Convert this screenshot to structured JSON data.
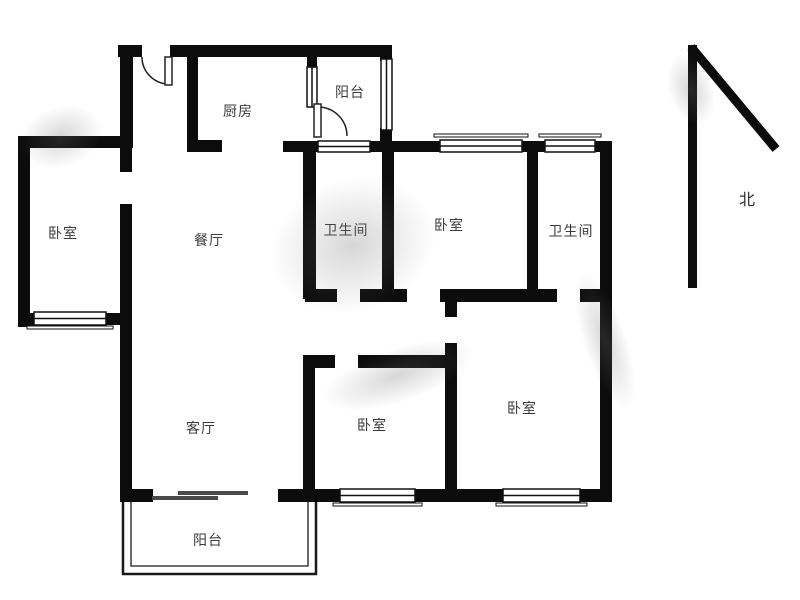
{
  "meta": {
    "type": "apartment-floor-plan"
  },
  "palette": {
    "background": "#ffffff",
    "wall": "#0c0c0c",
    "window_stroke": "#111111",
    "label_color": "#3b3b3b",
    "balcony_outline": "#1a1a1a"
  },
  "compass": {
    "label": "北"
  },
  "rooms": [
    {
      "id": "kitchen",
      "label": "厨房"
    },
    {
      "id": "balcony-top",
      "label": "阳台"
    },
    {
      "id": "bedroom-left",
      "label": "卧室"
    },
    {
      "id": "dining",
      "label": "餐厅"
    },
    {
      "id": "bathroom-1",
      "label": "卫生间"
    },
    {
      "id": "bedroom-top",
      "label": "卧室"
    },
    {
      "id": "bathroom-2",
      "label": "卫生间"
    },
    {
      "id": "living",
      "label": "客厅"
    },
    {
      "id": "bedroom-small",
      "label": "卧室"
    },
    {
      "id": "bedroom-right",
      "label": "卧室"
    },
    {
      "id": "balcony-bottom",
      "label": "阳台"
    }
  ]
}
